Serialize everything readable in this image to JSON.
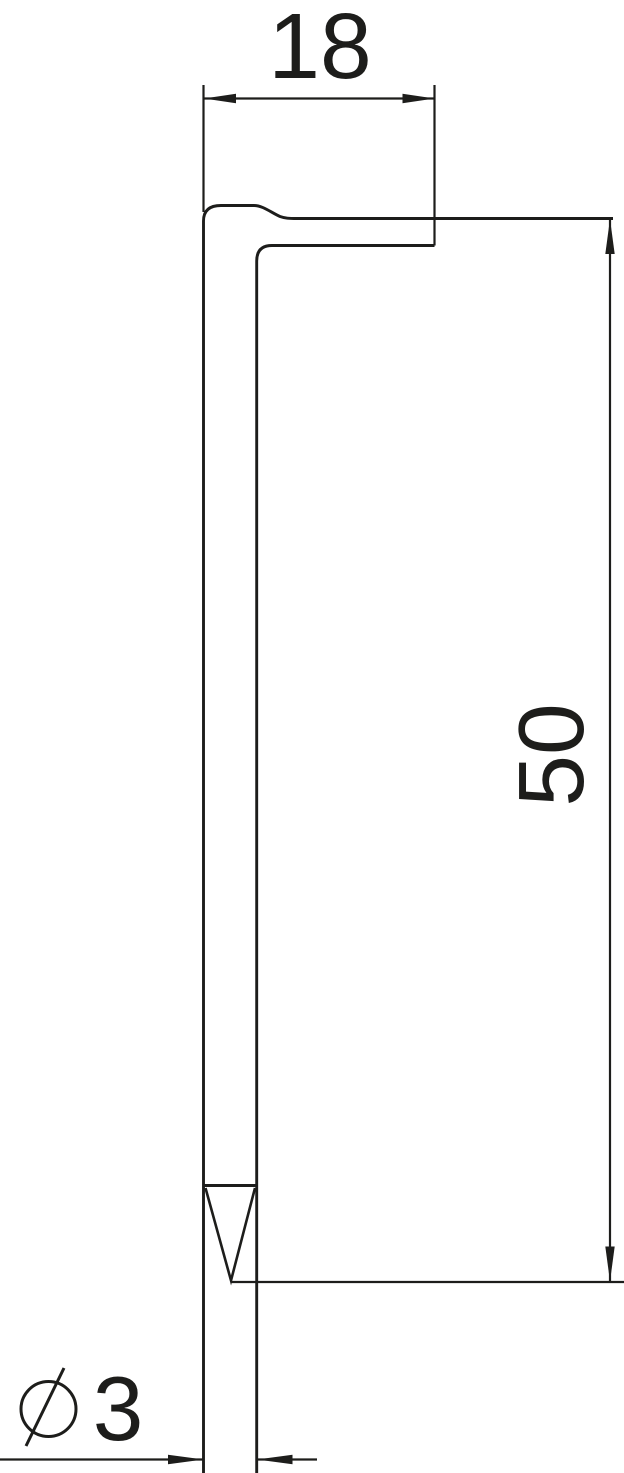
{
  "drawing": {
    "kind": "dimension-drawing",
    "labels": {
      "width": "18",
      "height": "50",
      "diameter": "3",
      "diameter_symbol": "⌀"
    },
    "colors": {
      "line": "#1d1d1b",
      "text": "#1d1d1b",
      "background": "#ffffff"
    }
  }
}
